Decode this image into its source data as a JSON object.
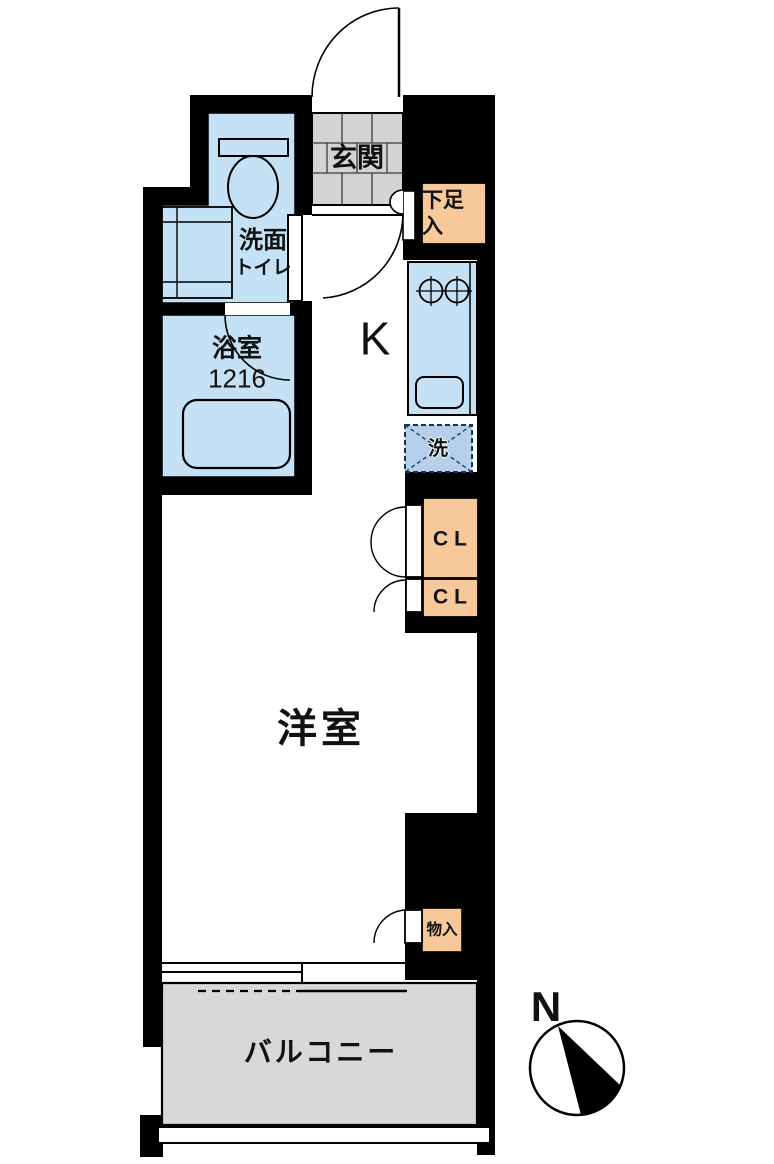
{
  "floorplan": {
    "type": "apartment-floor-plan",
    "labels": {
      "genkan": "玄関",
      "shoe_line1": "下足",
      "shoe_line2": "入",
      "washroom_line1": "洗面",
      "washroom_line2": "トイレ",
      "bathroom": "浴室",
      "bathroom_size": "1216",
      "kitchen": "K",
      "washer": "洗",
      "closet_upper": "CL",
      "closet_lower": "CL",
      "western_room": "洋室",
      "storage": "物入",
      "balcony": "バルコニー",
      "compass_north": "N"
    },
    "colors": {
      "wall": "#000000",
      "room_blue": "#C5E1F5",
      "washer_blue": "#B6D0EB",
      "cabinet_orange": "#F6C89A",
      "tile_grey": "#D3D3D3",
      "balcony_grey": "#D8D8D8"
    }
  }
}
